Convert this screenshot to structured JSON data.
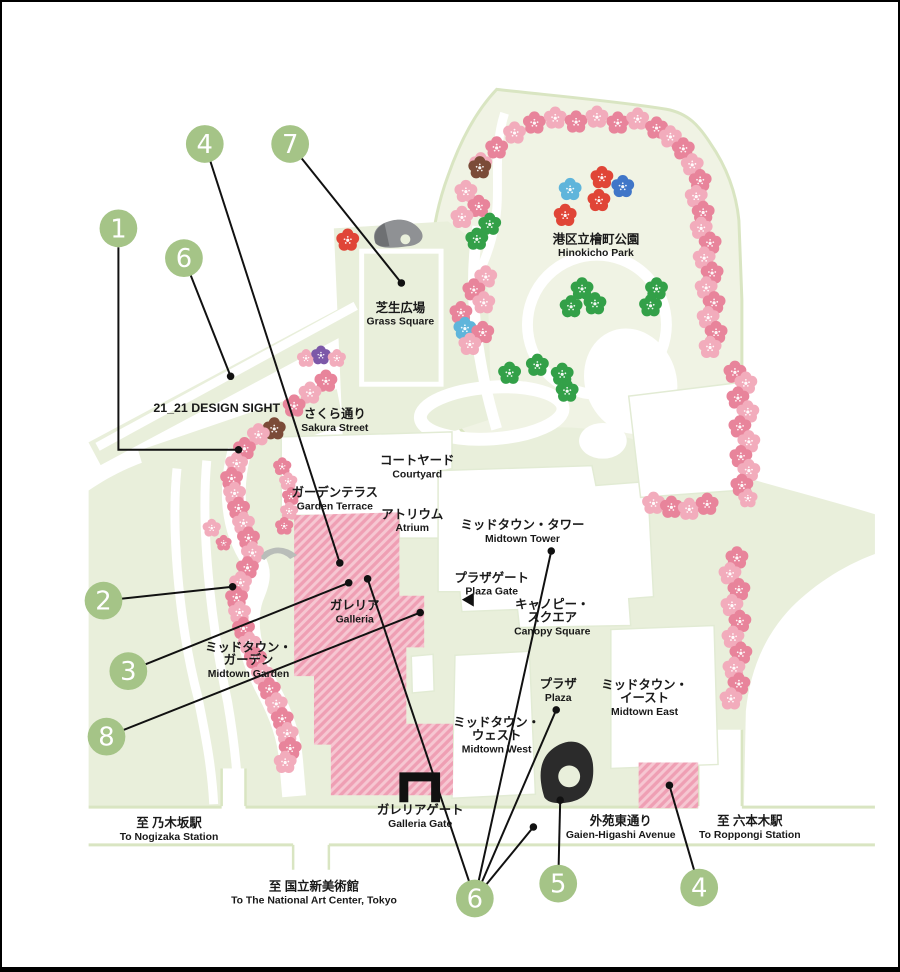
{
  "map_title": "Tokyo Midtown sakura map",
  "colors": {
    "callout_green": "#A5C487",
    "leader_line": "#111111",
    "park_fill": "#F0F3E4",
    "block_fill": "#E9EFDB",
    "edge_green": "#D9E5C2",
    "hatch_base": "#EF9FB4",
    "hatch_stripe": "#F6C7D2",
    "black_icon": "#1c1c1c",
    "gray_icon": "#8f9194"
  },
  "flower_palette": {
    "p": "#F2ACBC",
    "r": "#E8849B",
    "d": "#E04537",
    "g": "#33A048",
    "b": "#4076C8",
    "c": "#5FB5DB",
    "v": "#7C58A8",
    "w": "#7B4B38"
  },
  "map_labels": [
    {
      "id": "hinokicho-park",
      "lines": [
        "港区立檜町公園"
      ],
      "en": "Hinokicho Park",
      "x": 597,
      "y": 243
    },
    {
      "id": "grass-square",
      "lines": [
        "芝生広場"
      ],
      "en": "Grass Square",
      "x": 400,
      "y": 312
    },
    {
      "id": "design-sight",
      "lines": [
        "21_21 DESIGN SIGHT"
      ],
      "en": "",
      "x": 215,
      "y": 413
    },
    {
      "id": "sakura-street",
      "lines": [
        "さくら通り"
      ],
      "en": "Sakura Street",
      "x": 334,
      "y": 419
    },
    {
      "id": "courtyard",
      "lines": [
        "コートヤード"
      ],
      "en": "Courtyard",
      "x": 417,
      "y": 466
    },
    {
      "id": "garden-terrace",
      "lines": [
        "ガーデンテラス"
      ],
      "en": "Garden Terrace",
      "x": 334,
      "y": 498
    },
    {
      "id": "atrium",
      "lines": [
        "アトリウム"
      ],
      "en": "Atrium",
      "x": 412,
      "y": 520
    },
    {
      "id": "midtown-tower",
      "lines": [
        "ミッドタウン・タワー"
      ],
      "en": "Midtown Tower",
      "x": 523,
      "y": 531
    },
    {
      "id": "plaza-gate",
      "lines": [
        "プラザゲート"
      ],
      "en": "Plaza Gate",
      "x": 492,
      "y": 584
    },
    {
      "id": "canopy-square",
      "lines": [
        "キャノピー・",
        "スクエア"
      ],
      "en": "Canopy Square",
      "x": 553,
      "y": 611
    },
    {
      "id": "galleria",
      "lines": [
        "ガレリア"
      ],
      "en": "Galleria",
      "x": 354,
      "y": 612
    },
    {
      "id": "midtown-garden",
      "lines": [
        "ミッドタウン・",
        "ガーデン"
      ],
      "en": "Midtown Garden",
      "x": 247,
      "y": 654
    },
    {
      "id": "plaza",
      "lines": [
        "プラザ"
      ],
      "en": "Plaza",
      "x": 559,
      "y": 691
    },
    {
      "id": "midtown-east",
      "lines": [
        "ミッドタウン・",
        "イースト"
      ],
      "en": "Midtown East",
      "x": 646,
      "y": 692
    },
    {
      "id": "midtown-west",
      "lines": [
        "ミッドタウン・",
        "ウェスト"
      ],
      "en": "Midtown West",
      "x": 497,
      "y": 730
    },
    {
      "id": "galleria-gate",
      "lines": [
        "ガレリアゲート"
      ],
      "en": "Galleria Gate",
      "x": 420,
      "y": 818
    },
    {
      "id": "to-nogizaka",
      "lines": [
        "至 乃木坂駅"
      ],
      "en": "To Nogizaka Station",
      "x": 167,
      "y": 831
    },
    {
      "id": "gaien-higashi",
      "lines": [
        "外苑東通り"
      ],
      "en": "Gaien-Higashi Avenue",
      "x": 622,
      "y": 829
    },
    {
      "id": "to-roppongi",
      "lines": [
        "至 六本木駅"
      ],
      "en": "To Roppongi Station",
      "x": 752,
      "y": 829
    },
    {
      "id": "to-art-center",
      "lines": [
        "至 国立新美術館"
      ],
      "en": "To The National Art Center, Tokyo",
      "x": 313,
      "y": 895
    }
  ],
  "callouts": [
    {
      "n": "4",
      "cx": 203,
      "cy": 143,
      "targets": [
        [
          339,
          565
        ]
      ]
    },
    {
      "n": "7",
      "cx": 289,
      "cy": 143,
      "targets": [
        [
          401,
          283
        ]
      ]
    },
    {
      "n": "1",
      "cx": 116,
      "cy": 228,
      "poly": [
        [
          116,
          247
        ],
        [
          116,
          451
        ],
        [
          237,
          451
        ]
      ]
    },
    {
      "n": "6",
      "cx": 182,
      "cy": 258,
      "targets": [
        [
          229,
          377
        ]
      ]
    },
    {
      "n": "2",
      "cx": 101,
      "cy": 603,
      "targets": [
        [
          231,
          589
        ]
      ]
    },
    {
      "n": "3",
      "cx": 126,
      "cy": 674,
      "targets": [
        [
          348,
          585
        ]
      ]
    },
    {
      "n": "8",
      "cx": 104,
      "cy": 740,
      "targets": [
        [
          420,
          615
        ]
      ]
    },
    {
      "n": "6",
      "cx": 475,
      "cy": 903,
      "targets": [
        [
          367,
          581
        ],
        [
          552,
          553
        ],
        [
          557,
          713
        ],
        [
          534,
          831
        ]
      ]
    },
    {
      "n": "5",
      "cx": 559,
      "cy": 888,
      "targets": [
        [
          561,
          804
        ]
      ]
    },
    {
      "n": "4",
      "cx": 701,
      "cy": 892,
      "targets": [
        [
          671,
          789
        ]
      ]
    }
  ],
  "flowers": [
    [
      481,
      163,
      "p"
    ],
    [
      497,
      147,
      "r"
    ],
    [
      515,
      132,
      "p"
    ],
    [
      535,
      122,
      "r"
    ],
    [
      556,
      117,
      "p"
    ],
    [
      577,
      121,
      "r"
    ],
    [
      598,
      116,
      "p"
    ],
    [
      619,
      122,
      "r"
    ],
    [
      639,
      118,
      "p"
    ],
    [
      658,
      127,
      "r"
    ],
    [
      672,
      136,
      "p"
    ],
    [
      685,
      148,
      "r"
    ],
    [
      694,
      164,
      "p"
    ],
    [
      702,
      180,
      "r"
    ],
    [
      698,
      196,
      "p"
    ],
    [
      705,
      212,
      "r"
    ],
    [
      703,
      228,
      "p"
    ],
    [
      712,
      243,
      "r"
    ],
    [
      706,
      258,
      "p"
    ],
    [
      714,
      273,
      "r"
    ],
    [
      708,
      288,
      "p"
    ],
    [
      716,
      303,
      "r"
    ],
    [
      710,
      318,
      "p"
    ],
    [
      718,
      333,
      "r"
    ],
    [
      712,
      348,
      "p"
    ],
    [
      737,
      373,
      "r"
    ],
    [
      748,
      384,
      "p"
    ],
    [
      740,
      399,
      "r"
    ],
    [
      750,
      413,
      "p"
    ],
    [
      742,
      428,
      "r"
    ],
    [
      751,
      443,
      "p"
    ],
    [
      743,
      458,
      "r"
    ],
    [
      751,
      472,
      "p"
    ],
    [
      744,
      487,
      "r"
    ],
    [
      750,
      500,
      "p",
      0.85
    ],
    [
      739,
      560,
      "r"
    ],
    [
      732,
      576,
      "p"
    ],
    [
      741,
      592,
      "r"
    ],
    [
      734,
      608,
      "p"
    ],
    [
      742,
      624,
      "r"
    ],
    [
      735,
      640,
      "p"
    ],
    [
      743,
      656,
      "r"
    ],
    [
      736,
      671,
      "p"
    ],
    [
      741,
      687,
      "r"
    ],
    [
      733,
      702,
      "p"
    ],
    [
      655,
      505,
      "p"
    ],
    [
      673,
      509,
      "r"
    ],
    [
      691,
      511,
      "p"
    ],
    [
      709,
      506,
      "r"
    ],
    [
      480,
      167,
      "w"
    ],
    [
      466,
      191,
      "p"
    ],
    [
      479,
      206,
      "r"
    ],
    [
      462,
      217,
      "p"
    ],
    [
      490,
      224,
      "g"
    ],
    [
      477,
      239,
      "g"
    ],
    [
      571,
      189,
      "c"
    ],
    [
      603,
      177,
      "d"
    ],
    [
      624,
      186,
      "b"
    ],
    [
      600,
      200,
      "d"
    ],
    [
      566,
      215,
      "d"
    ],
    [
      347,
      240,
      "d"
    ],
    [
      486,
      277,
      "p"
    ],
    [
      474,
      290,
      "r"
    ],
    [
      484,
      303,
      "p"
    ],
    [
      461,
      313,
      "r"
    ],
    [
      465,
      329,
      "c"
    ],
    [
      483,
      333,
      "r"
    ],
    [
      470,
      345,
      "p"
    ],
    [
      583,
      289,
      "g"
    ],
    [
      596,
      304,
      "g"
    ],
    [
      572,
      307,
      "g"
    ],
    [
      658,
      289,
      "g"
    ],
    [
      652,
      306,
      "g"
    ],
    [
      510,
      374,
      "g"
    ],
    [
      538,
      366,
      "g"
    ],
    [
      563,
      375,
      "g"
    ],
    [
      568,
      392,
      "g"
    ],
    [
      305,
      359,
      "p",
      0.8
    ],
    [
      320,
      356,
      "v",
      0.85
    ],
    [
      336,
      359,
      "p",
      0.8
    ],
    [
      325,
      382,
      "r"
    ],
    [
      309,
      394,
      "p"
    ],
    [
      293,
      407,
      "r"
    ],
    [
      273,
      430,
      "w"
    ],
    [
      257,
      436,
      "p"
    ],
    [
      243,
      450,
      "r"
    ],
    [
      235,
      465,
      "p"
    ],
    [
      230,
      480,
      "r"
    ],
    [
      233,
      495,
      "p"
    ],
    [
      237,
      510,
      "r"
    ],
    [
      242,
      525,
      "p"
    ],
    [
      247,
      540,
      "r"
    ],
    [
      251,
      555,
      "p"
    ],
    [
      246,
      570,
      "r"
    ],
    [
      239,
      585,
      "p"
    ],
    [
      235,
      600,
      "r"
    ],
    [
      238,
      615,
      "p"
    ],
    [
      242,
      631,
      "r"
    ],
    [
      248,
      646,
      "p"
    ],
    [
      254,
      661,
      "r"
    ],
    [
      261,
      677,
      "p"
    ],
    [
      268,
      692,
      "r"
    ],
    [
      275,
      707,
      "p"
    ],
    [
      281,
      722,
      "r"
    ],
    [
      286,
      737,
      "p"
    ],
    [
      289,
      752,
      "r"
    ],
    [
      284,
      766,
      "p"
    ],
    [
      281,
      468,
      "r",
      0.8
    ],
    [
      287,
      483,
      "p",
      0.8
    ],
    [
      290,
      498,
      "r",
      0.8
    ],
    [
      288,
      513,
      "p",
      0.8
    ],
    [
      283,
      528,
      "r",
      0.8
    ],
    [
      210,
      530,
      "p",
      0.8
    ],
    [
      222,
      545,
      "r",
      0.7
    ]
  ],
  "icons": {
    "galleria_gate": "gate-icon",
    "plaza_sculpture": "sculpture-icon",
    "grass_square_sculpture": "rock-sculpture-icon",
    "garden_arch": "arch-icon",
    "plaza_gate_marker": "triangle-left-icon",
    "flower_marker": "sakura-flower-icon"
  }
}
